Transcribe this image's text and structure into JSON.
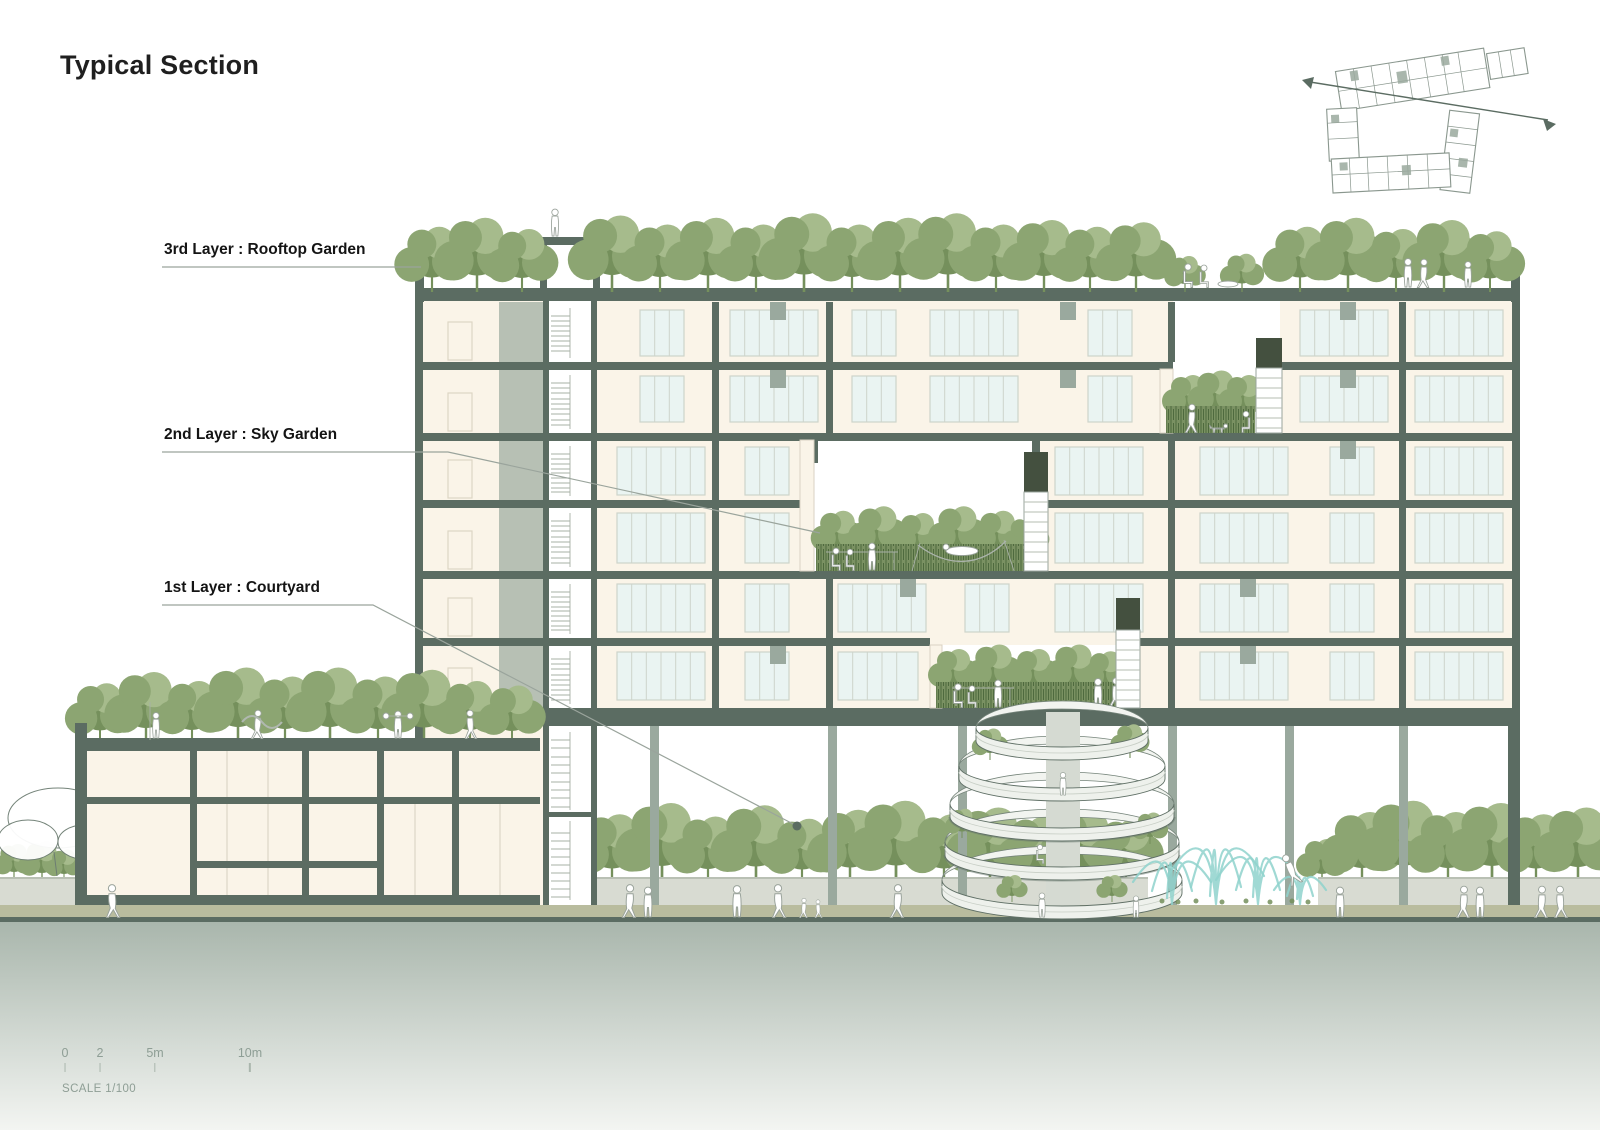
{
  "page": {
    "title": "Typical Section"
  },
  "labels": {
    "layer3": "3rd Layer : Rooftop Garden",
    "layer2": "2nd Layer : Sky Garden",
    "layer1": "1st Layer : Courtyard"
  },
  "scale_bar": {
    "ticks": [
      "0",
      "2",
      "5m",
      "10m"
    ],
    "caption": "SCALE 1/100"
  },
  "colors": {
    "structure": "#5b6c62",
    "structureLight": "#9aa99e",
    "room": "#faf4e8",
    "glass": "#eaf4f2",
    "glassFrame": "#cdd4cb",
    "tree": "#8ca572",
    "treeDark": "#75905c",
    "treeLight": "#a6bb8c",
    "hedgeFill": "#7a9162",
    "water": "#8fd2cd",
    "walkway": "#b9bc9e",
    "wallLight": "#d8dbd2",
    "belowTop": "#a9b6ac",
    "belowBottom": "#f3f5f2",
    "figure": "#9aa39b",
    "leader": "#9aa49c",
    "keyplan": "#8a978e",
    "title": "#1f1f1f",
    "mutedText": "#8e9e95"
  }
}
